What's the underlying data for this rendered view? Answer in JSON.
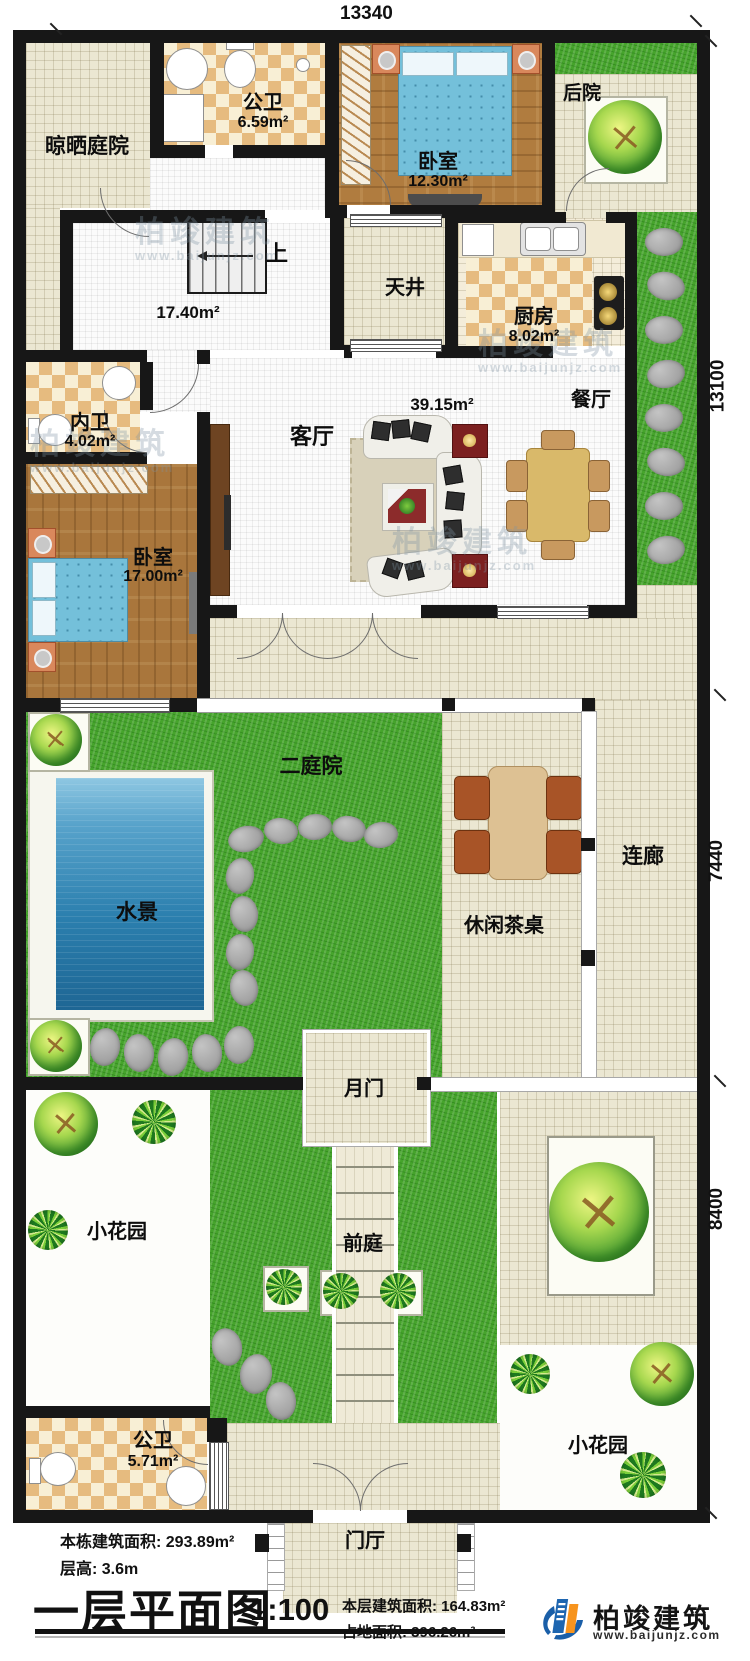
{
  "plan": {
    "dimensions": {
      "top": "13340",
      "right_top": "13100",
      "right_mid": "7440",
      "right_bottom": "8400"
    },
    "rooms": {
      "drying_yard": {
        "name": "晾晒庭院"
      },
      "bath1": {
        "name": "公卫",
        "area": "6.59m²"
      },
      "bedroom1": {
        "name": "卧室",
        "area": "12.30m²"
      },
      "backyard": {
        "name": "后院"
      },
      "stairs": {
        "up": "上"
      },
      "hall": {
        "area": "17.40m²"
      },
      "patio": {
        "name": "天井"
      },
      "kitchen": {
        "name": "厨房",
        "area": "8.02m²"
      },
      "dining": {
        "name": "餐厅"
      },
      "living": {
        "name": "客厅",
        "area": "39.15m²"
      },
      "bath_inner": {
        "name": "内卫",
        "area": "4.02m²"
      },
      "bedroom2": {
        "name": "卧室",
        "area": "17.00m²"
      },
      "courtyard2": {
        "name": "二庭院"
      },
      "water": {
        "name": "水景"
      },
      "corridor": {
        "name": "连廊"
      },
      "tea_table": {
        "name": "休闲茶桌"
      },
      "moon_gate": {
        "name": "月门"
      },
      "front_yard": {
        "name": "前庭"
      },
      "garden_left": {
        "name": "小花园"
      },
      "garden_right": {
        "name": "小花园"
      },
      "bath2": {
        "name": "公卫",
        "area": "5.71m²"
      },
      "foyer": {
        "name": "门厅"
      }
    },
    "info": {
      "building_area": "本栋建筑面积: 293.89m²",
      "floor_height": "层高: 3.6m",
      "title": "一层平面图",
      "scale": "1:100",
      "floor_area": "本层建筑面积: 164.83m²",
      "footprint": "占地面积: 396.26m²"
    },
    "logo": {
      "name": "柏竣建筑",
      "url": "www.baijunjz.com"
    },
    "watermark": {
      "name": "柏竣建筑",
      "url": "www.baijunjz.com"
    }
  }
}
